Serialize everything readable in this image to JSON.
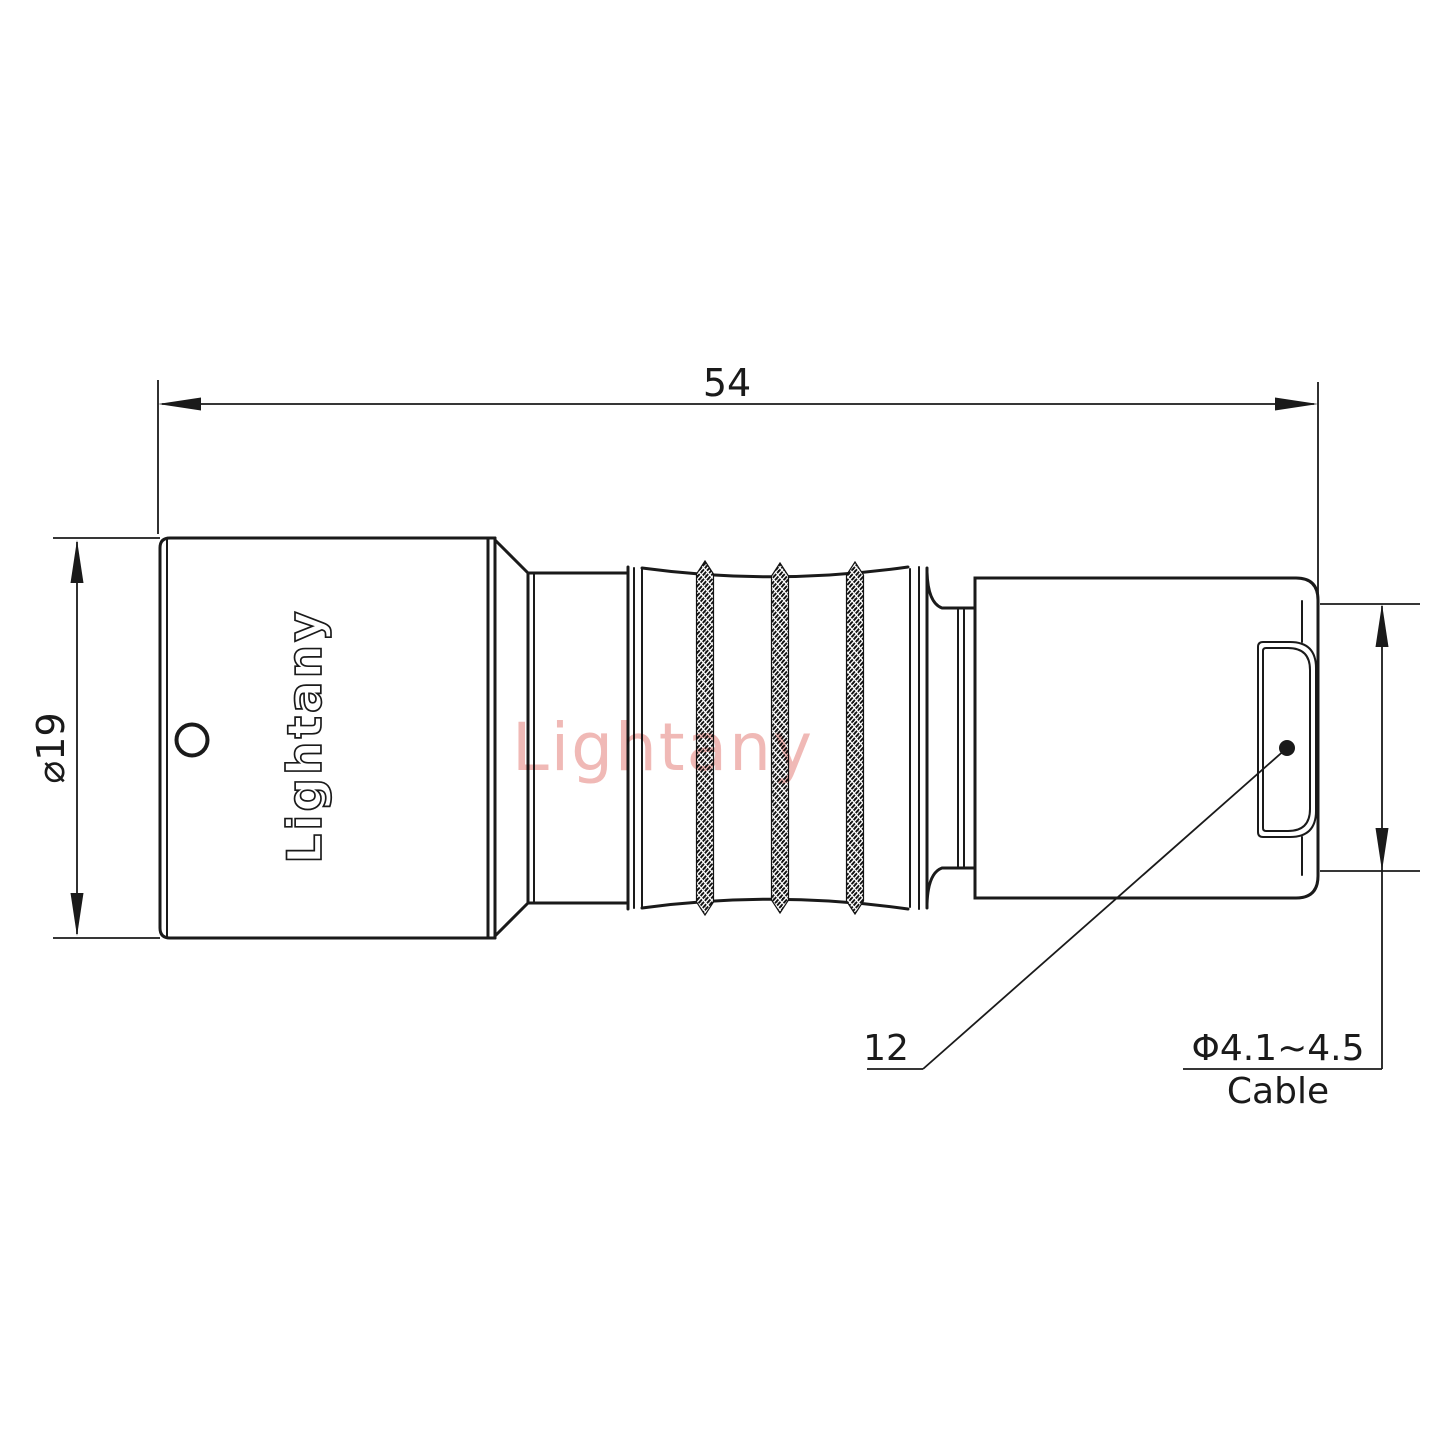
{
  "title": "Connector technical drawing",
  "brand": "Lightany",
  "watermark": "Lightany",
  "dimensions": {
    "overall_length": "54",
    "outer_diameter": "⌀19",
    "boot_ref": "12",
    "cable_diameter": "Φ4.1~4.5",
    "cable_word": "Cable"
  },
  "colors": {
    "line": "#1a1a1a",
    "watermark_pink": "#f0b9b6",
    "background": "#ffffff"
  }
}
